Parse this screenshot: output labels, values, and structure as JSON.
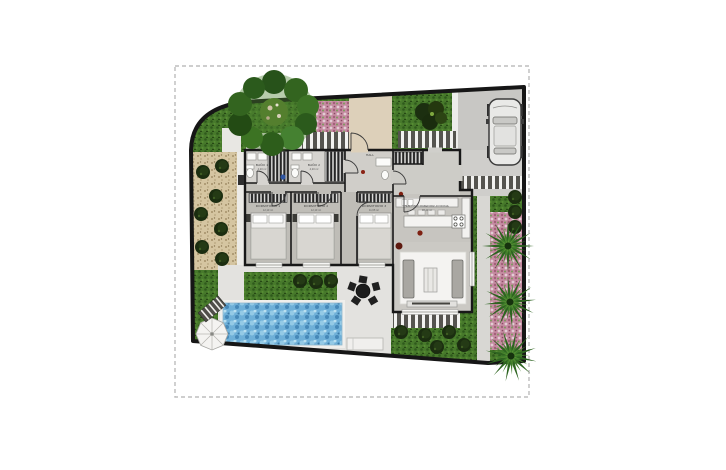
{
  "plan": {
    "type": "villa-site-floor-plan",
    "rooms": [
      {
        "name": "BAÑO 1",
        "area": "4,20 m²"
      },
      {
        "name": "BAÑO 2",
        "area": "4,20 m²"
      },
      {
        "name": "DORMITORIO 1",
        "area": "12,10 m²"
      },
      {
        "name": "DORMITORIO 2",
        "area": "12,10 m²"
      },
      {
        "name": "DORMITORIO 3",
        "area": "11,65 m²"
      },
      {
        "name": "HALL",
        "area": "5,30 m²"
      },
      {
        "name": "SALÓN-COMEDOR-COCINA",
        "area": "38,40 m²"
      }
    ],
    "outdoor_features": [
      "lawn",
      "gravel-garden",
      "pink-flower-beds",
      "large-tree",
      "palm-trees",
      "swimming-pool",
      "pool-deck",
      "parasol",
      "sun-loungers",
      "outdoor-dining-table",
      "driveway",
      "parked-car",
      "striped-walkways",
      "zebra-path"
    ],
    "palette": {
      "grass": "#47792b",
      "gravel": "#d5c5a1",
      "flowers_pink": "#c58ba1",
      "pool_water": "#6fb0d8",
      "deck": "#e3e2df",
      "driveway": "#c8c7c4",
      "walls": "#181818",
      "floor": "#c2c0ba",
      "entry_plaza": "#ddd0ba",
      "boundary": "#161616"
    }
  }
}
